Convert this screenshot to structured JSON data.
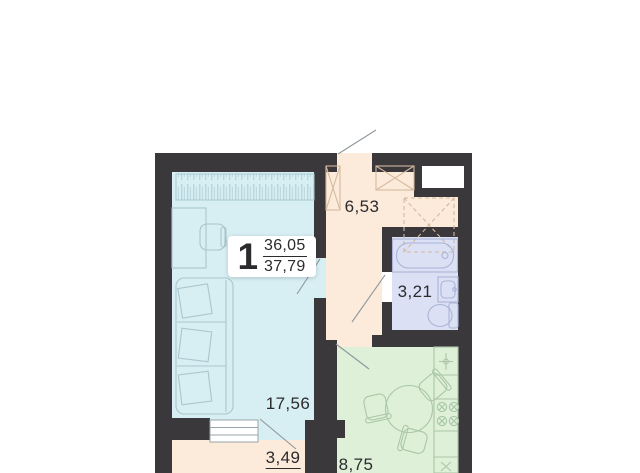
{
  "meta": {
    "type": "apartment-floor-plan"
  },
  "unit": {
    "number": "1",
    "area_upper": "36,05",
    "area_lower": "37,79"
  },
  "rooms": {
    "hallway": {
      "name": "hallway",
      "area": "6,53"
    },
    "bathroom": {
      "name": "bathroom",
      "area": "3,21"
    },
    "living_room": {
      "name": "living-room",
      "area": "17,56"
    },
    "kitchen": {
      "name": "kitchen",
      "area": "8,75"
    },
    "balcony": {
      "name": "balcony",
      "area": "3,49",
      "area_underlined": true
    }
  },
  "colors": {
    "wall": "#3a383b",
    "living": "#d7eef3",
    "hall": "#fcebda",
    "bath": "#dbe0f4",
    "kitchen": "#def0d8",
    "balcony": "#fcebda",
    "label-text": "#2b2b2e",
    "leader-line": "#8f979c",
    "furniture-cyan": "#a9c6cd",
    "furniture-beige": "#d3b99e",
    "furniture-bath": "#aab4d6",
    "furniture-green": "#abc6a8",
    "label-bg": "#ffffff",
    "background": "#ffffff"
  }
}
